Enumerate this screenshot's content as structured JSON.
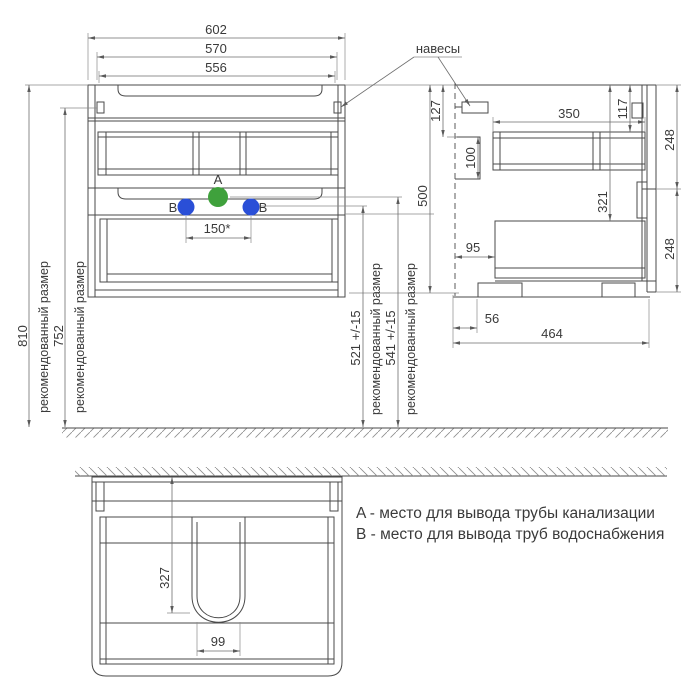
{
  "drawing": {
    "labels": {
      "hangers": "навесы",
      "recommended": "рекомендованный размер"
    },
    "points": {
      "a": "A",
      "b": "B"
    },
    "colors": {
      "point_a": "#3FA13C",
      "point_b": "#2A4FD7"
    },
    "front_view": {
      "width_outer": "602",
      "width_frame": "570",
      "width_inner": "556",
      "height_to_floor": "810",
      "height_to_hangers": "752",
      "water_points_spacing": "150*",
      "drain_point_height": "541 +/-15",
      "water_point_height": "521 +/-15"
    },
    "side_view": {
      "height": "500",
      "hanger_top_offset": "127",
      "rail_height": "100",
      "shelf_depth": "350",
      "front_top_offset": "117",
      "top_front_height": "248",
      "bottom_front_height": "248",
      "drawer_top_offset": "321",
      "back_gap": "95",
      "foot_inset": "56",
      "depth": "464"
    },
    "plan_view": {
      "cutout_depth": "327",
      "cutout_width": "99"
    },
    "legend": {
      "a": "A - место для вывода трубы канализации",
      "b": "B - место для вывода труб водоснабжения"
    }
  }
}
